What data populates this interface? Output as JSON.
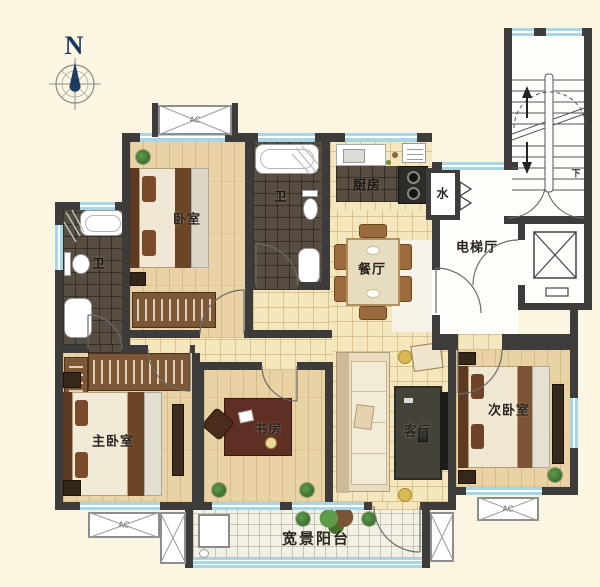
{
  "compass": {
    "north": "N"
  },
  "rooms": {
    "bedroom": {
      "label": "卧室"
    },
    "bath_top": {
      "label": "卫"
    },
    "bath_left": {
      "label": "卫"
    },
    "kitchen": {
      "label": "厨房"
    },
    "water": {
      "label": "水"
    },
    "dining": {
      "label": "餐厅"
    },
    "elevator_hall": {
      "label": "电梯厅"
    },
    "master_bedroom": {
      "label": "主卧室"
    },
    "study": {
      "label": "书房"
    },
    "living": {
      "label": "客厅"
    },
    "secondary_bedroom": {
      "label": "次卧室"
    },
    "balcony": {
      "label": "宽景阳台"
    }
  },
  "annotations": {
    "ac": "AC",
    "stairs_down": "下"
  },
  "colors": {
    "wall": "#3d3c3a",
    "window": "#a9d6e4",
    "wood": "#e9d2a4",
    "tile": "#f4e7bd",
    "dark_tile": "#574d40",
    "background": "#fcf5e2",
    "compass_needle": "#1d3a5f"
  }
}
